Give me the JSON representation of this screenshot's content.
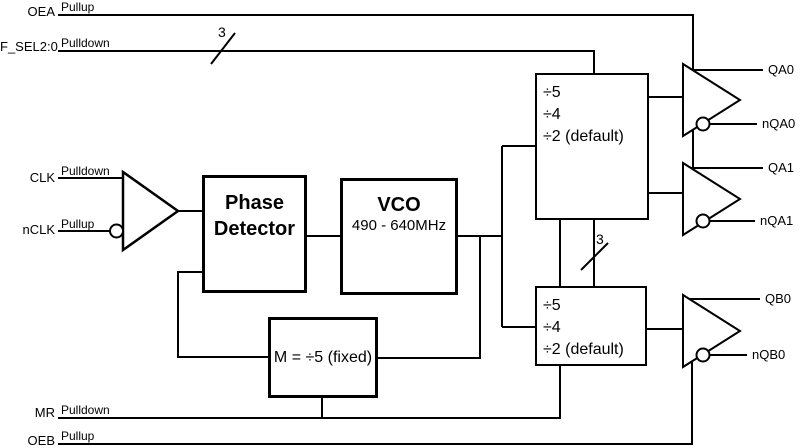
{
  "signals": {
    "inputs": [
      {
        "name": "OEA",
        "resistor": "Pullup"
      },
      {
        "name": "F_SEL2:0",
        "resistor": "Pulldown"
      },
      {
        "name": "CLK",
        "resistor": "Pulldown"
      },
      {
        "name": "nCLK",
        "resistor": "Pullup"
      },
      {
        "name": "MR",
        "resistor": "Pulldown"
      },
      {
        "name": "OEB",
        "resistor": "Pullup"
      }
    ],
    "outputs": [
      "QA0",
      "nQA0",
      "QA1",
      "nQA1",
      "QB0",
      "nQB0"
    ]
  },
  "blocks": {
    "phase_detector": {
      "line1": "Phase",
      "line2": "Detector"
    },
    "vco": {
      "name": "VCO",
      "range": "490 - 640MHz"
    },
    "divider_a": {
      "rows": [
        "÷5",
        "÷4",
        "÷2 (default)"
      ]
    },
    "divider_b": {
      "rows": [
        "÷5",
        "÷4",
        "÷2 (default)"
      ]
    },
    "feedback_divider": {
      "label": "M = ÷5 (fixed)"
    }
  },
  "bus_widths": {
    "f_sel": "3",
    "divider_select": "3"
  },
  "colors": {
    "line": "#000000",
    "background": "#ffffff",
    "text": "#000000"
  }
}
